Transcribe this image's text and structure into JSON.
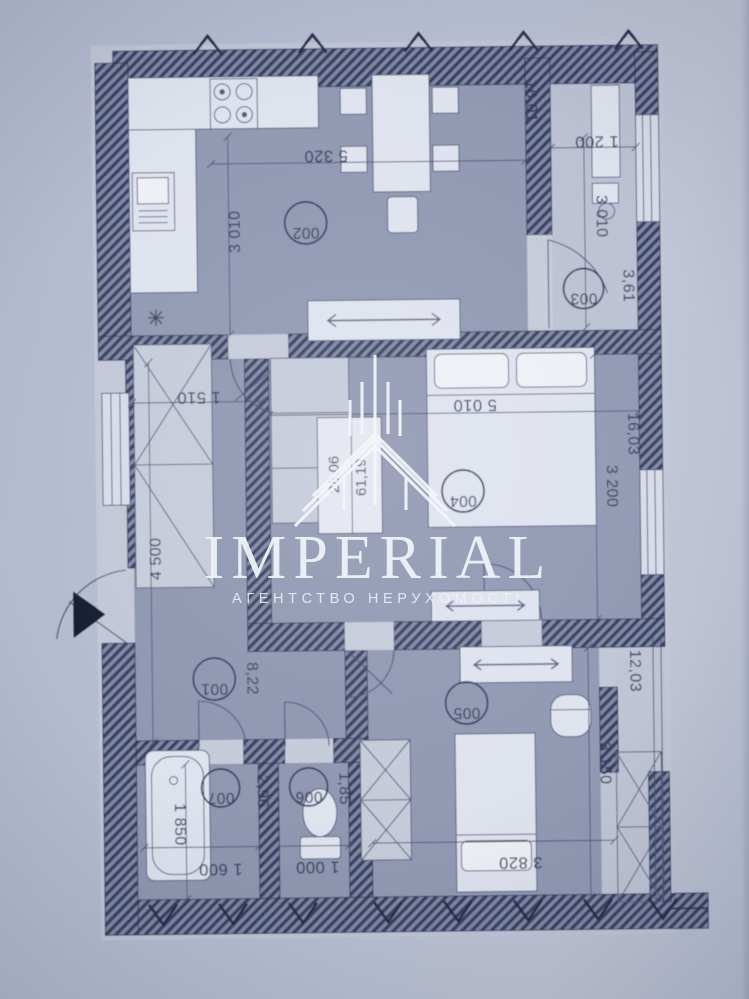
{
  "watermark": {
    "brand": "IMPERIAL",
    "tagline": "АГЕНТСТВО НЕРУХОМОСТІ",
    "logo": "highrise-spire-logo"
  },
  "plan": {
    "rooms": [
      {
        "number": "001",
        "area": "8,22"
      },
      {
        "number": "002",
        "area": "16,01"
      },
      {
        "number": "003",
        "area": "3,61"
      },
      {
        "number": "004",
        "area": "16,03"
      },
      {
        "number": "005",
        "area": "12,03"
      },
      {
        "number": "006",
        "area": "1,85"
      },
      {
        "number": "007",
        "area": "2,96"
      }
    ],
    "summary": {
      "living_area": "28,06",
      "total_area": "61,19"
    },
    "dimensions": {
      "living_top_width": "5 320",
      "loggia_top_width": "1 200",
      "kitchen_left_depth": "3 010",
      "loggia_length": "3 010",
      "hall_closet_width": "1 510",
      "bedroom1_width": "5 010",
      "bedroom1_depth": "3 200",
      "hall_height": "4 500",
      "bathroom_height": "1 850",
      "bathroom_width": "1 600",
      "wc_width": "1 000",
      "bedroom2_width": "3 820",
      "balcony_length": "3 150"
    },
    "entrance_marker": "right-pointing-triangle"
  }
}
